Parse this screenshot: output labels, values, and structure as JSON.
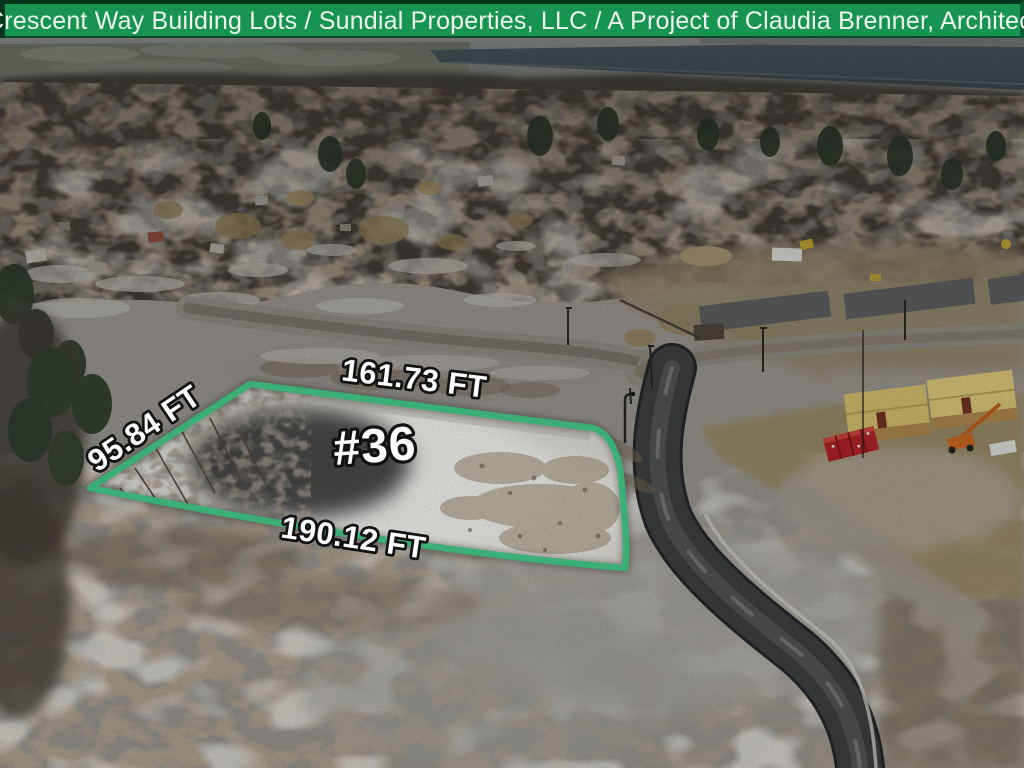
{
  "banner": {
    "title": "Crescent Way Building Lots / Sundial Properties, LLC / A Project of Claudia Brenner, Architect",
    "background_color": "#179450",
    "text_color": "#eef6f0"
  },
  "lot_annotation": {
    "lot_number": "#36",
    "dimension_top": "161.73 FT",
    "dimension_left": "95.84 FT",
    "dimension_bottom": "190.12 FT",
    "outline_color": "#39b176",
    "label_color": "#ffffff",
    "label_stroke_color": "#121212"
  }
}
